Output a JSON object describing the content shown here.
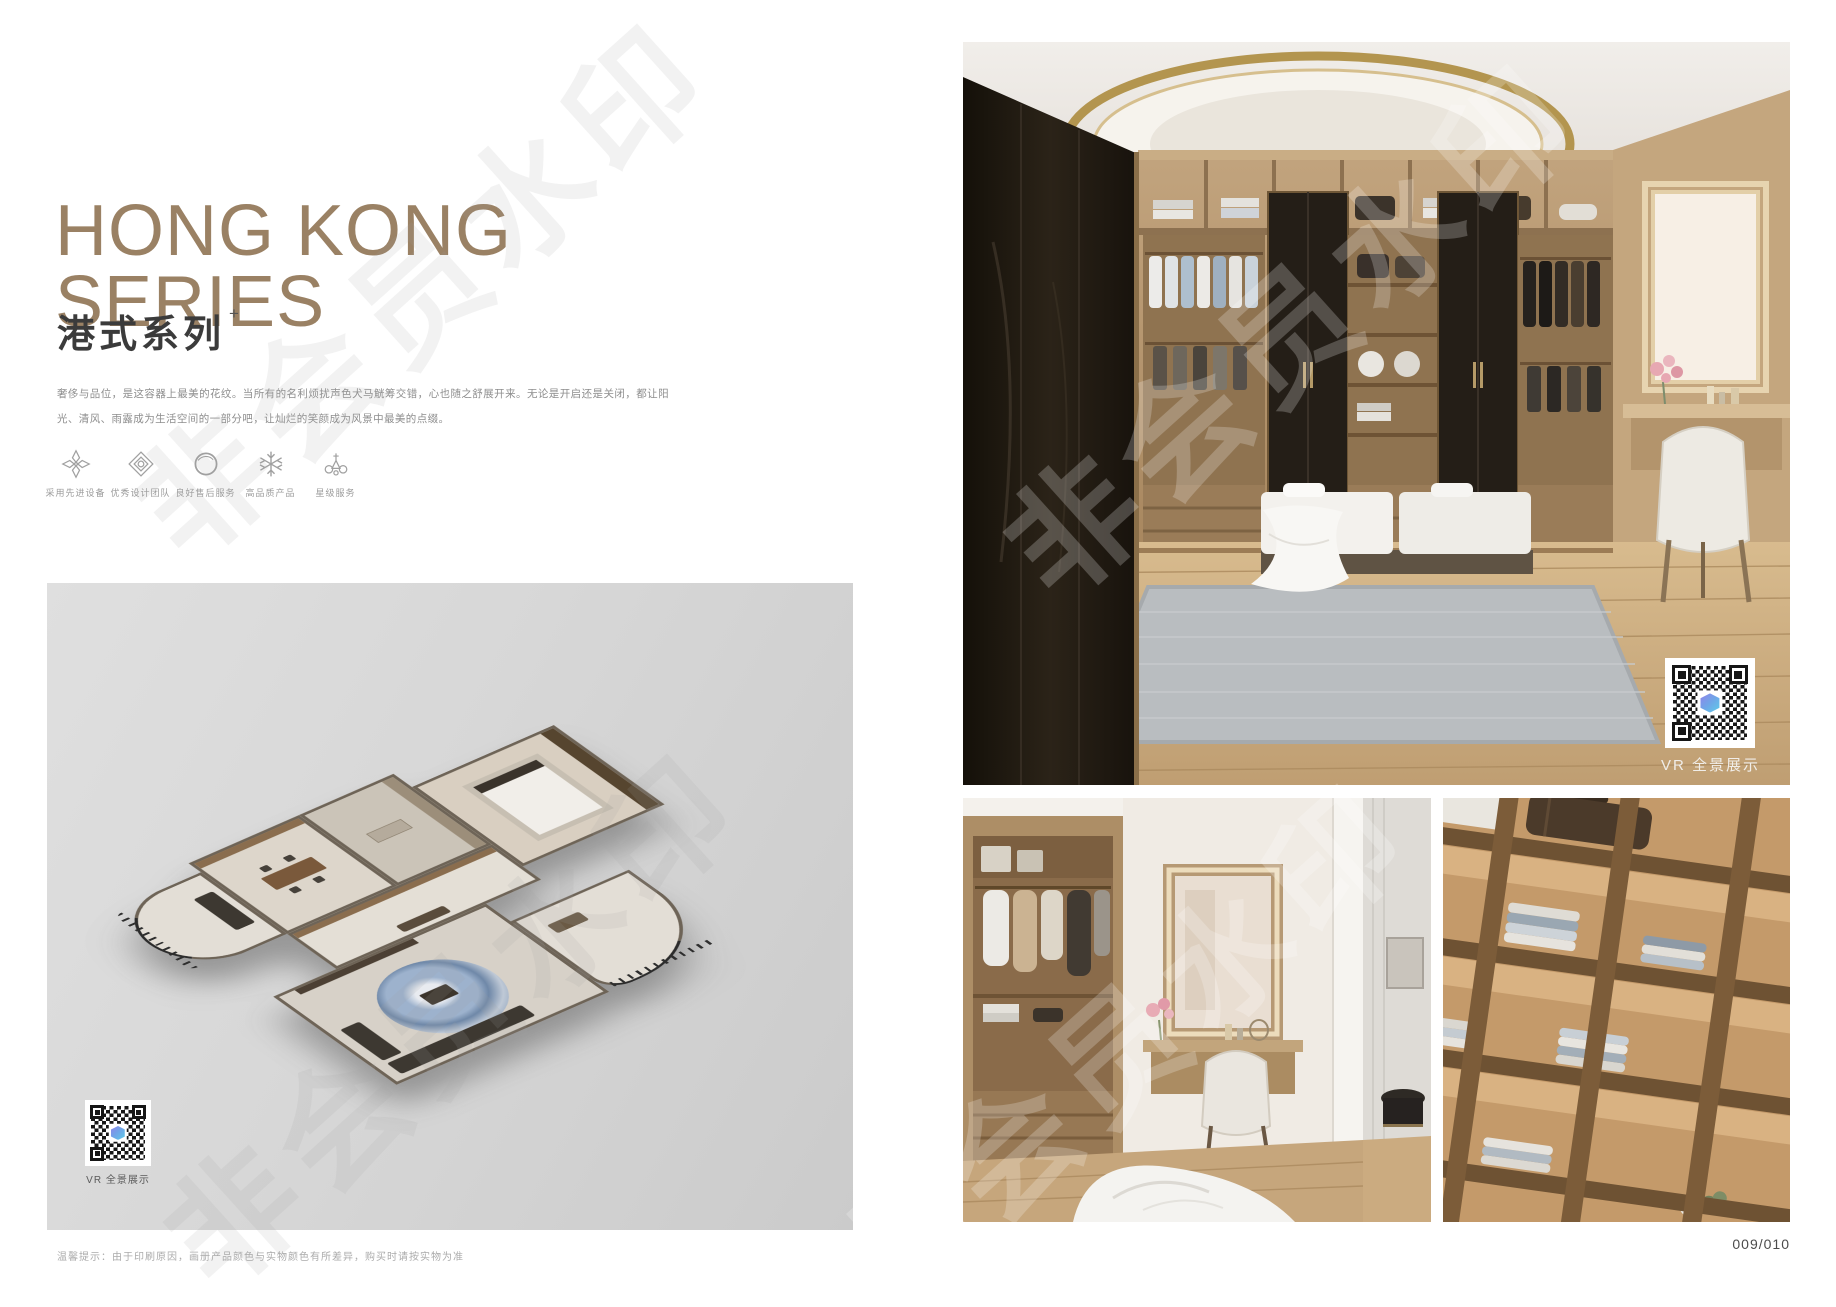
{
  "page": {
    "watermark": "非会员水印",
    "page_number": "009/010",
    "footer_tip": "温馨提示：由于印刷原因，画册产品颜色与实物颜色有所差异，购买时请按实物为准"
  },
  "header": {
    "title_line1": "HONG KONG",
    "title_line2": "SERIES",
    "subtitle": "港式系列",
    "subtitle_sup": "+",
    "description": "奢侈与品位，是这容器上最美的花纹。当所有的名利烦扰声色犬马觥筹交错，心也随之舒展开来。无论是开启还是关闭，都让阳光、清风、雨露成为生活空间的一部分吧，让灿烂的笑颜成为风景中最美的点缀。"
  },
  "features": [
    {
      "icon": "ornament-petal-icon",
      "label": "采用先进设备"
    },
    {
      "icon": "ornament-diamond-icon",
      "label": "优秀设计团队"
    },
    {
      "icon": "ring-icon",
      "label": "良好售后服务"
    },
    {
      "icon": "snowflake-icon",
      "label": "高品质产品"
    },
    {
      "icon": "crown-icon",
      "label": "星级服务"
    }
  ],
  "floorplan": {
    "vr_label": "VR 全景展示"
  },
  "gallery": {
    "vr_label": "VR 全景展示"
  },
  "colors": {
    "accent": "#9a8164",
    "panel_bg": "#d6d6d6",
    "text_muted": "#8e8e8e",
    "qr_logo": "#6fa6e8"
  }
}
